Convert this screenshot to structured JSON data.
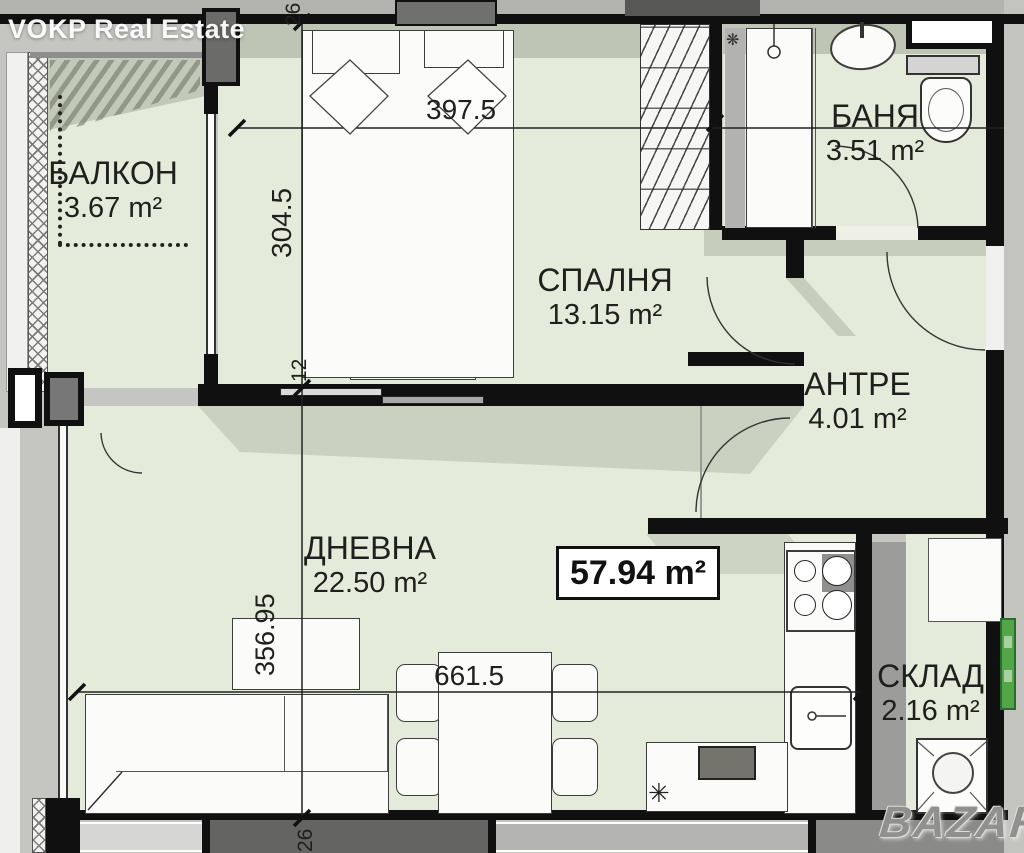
{
  "watermarks": {
    "agency": "VOKP Real Estate",
    "portal": "BAZAR"
  },
  "summary": {
    "total_area": "57.94 m²"
  },
  "rooms": [
    {
      "key": "balcony",
      "name": "БАЛКОН",
      "area": "3.67 m²"
    },
    {
      "key": "bedroom",
      "name": "СПАЛНЯ",
      "area": "13.15 m²"
    },
    {
      "key": "bathroom",
      "name": "БАНЯ",
      "area": "3.51 m²"
    },
    {
      "key": "entry",
      "name": "АНТРЕ",
      "area": "4.01 m²"
    },
    {
      "key": "living",
      "name": "ДНЕВНА",
      "area": "22.50 m²"
    },
    {
      "key": "storage",
      "name": "СКЛАД",
      "area": "2.16 m²"
    }
  ],
  "dimensions": {
    "bedroom_width": "397.5",
    "bedroom_depth": "304.5",
    "living_depth": "356.95",
    "living_width": "661.5",
    "wall_thickness_top": "26",
    "wall_thickness_partition": "12",
    "wall_thickness_bottom": "26"
  },
  "symbols": {
    "kitchen_note": "✳",
    "vent_fan": "❋"
  },
  "colors": {
    "floor": "#e5ebda",
    "wall": "#101010",
    "shadow": "#98a08f",
    "marker_green": "#53a647"
  }
}
